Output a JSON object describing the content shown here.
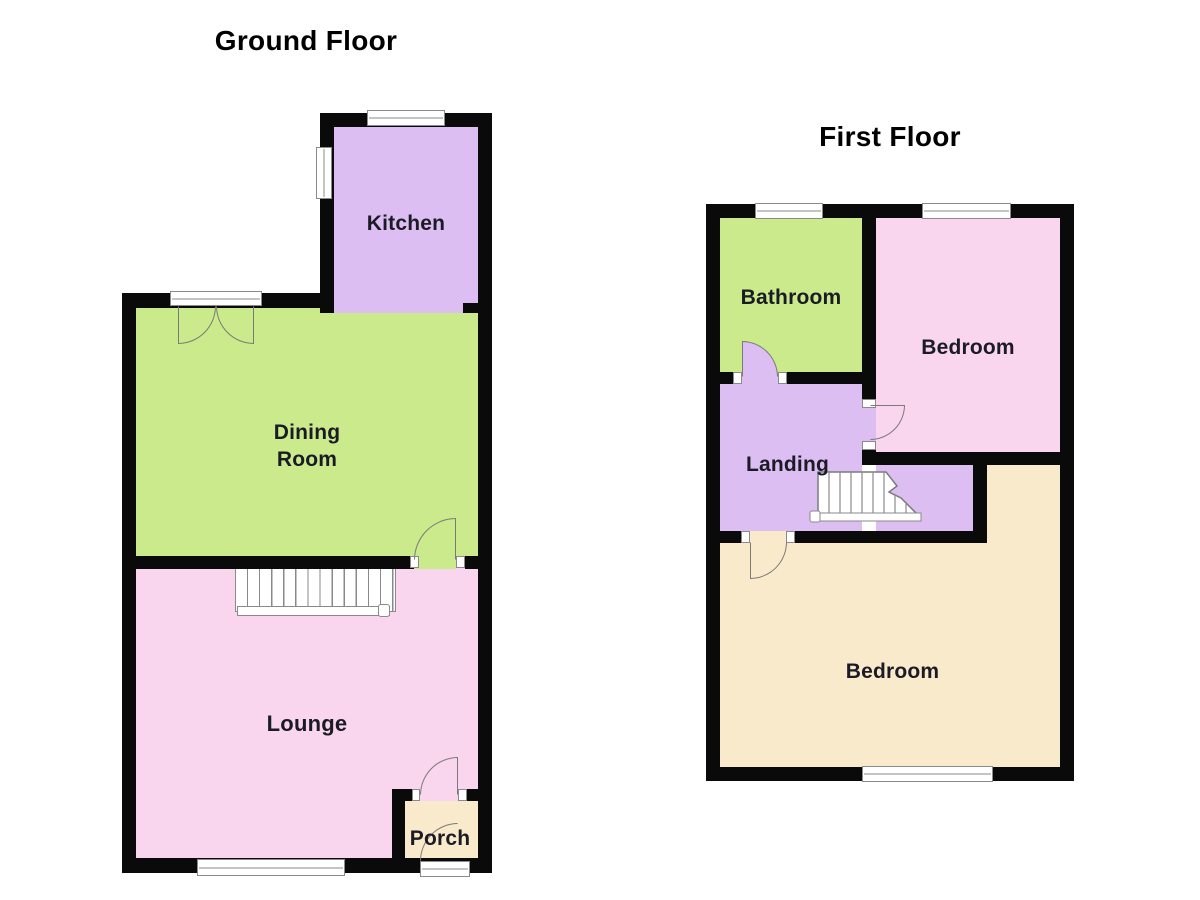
{
  "palette": {
    "background": "#ffffff",
    "wall": "#0a0a0a",
    "purple": "#dcbef2",
    "green": "#cbea8b",
    "pink": "#f9d6ee",
    "cream": "#faeacc",
    "window_frame": "#8a8a8a",
    "door_line": "#7a7a7a",
    "stair_line": "#8a8a8a",
    "label": "#1b1b26",
    "title": "#000000"
  },
  "floors": [
    {
      "title": "Ground Floor",
      "rooms": [
        {
          "label": "Kitchen"
        },
        {
          "label": "Dining\nRoom"
        },
        {
          "label": "Lounge"
        },
        {
          "label": "Porch"
        }
      ]
    },
    {
      "title": "First Floor",
      "rooms": [
        {
          "label": "Bathroom"
        },
        {
          "label": "Bedroom"
        },
        {
          "label": "Landing"
        },
        {
          "label": "Bedroom"
        }
      ]
    }
  ]
}
